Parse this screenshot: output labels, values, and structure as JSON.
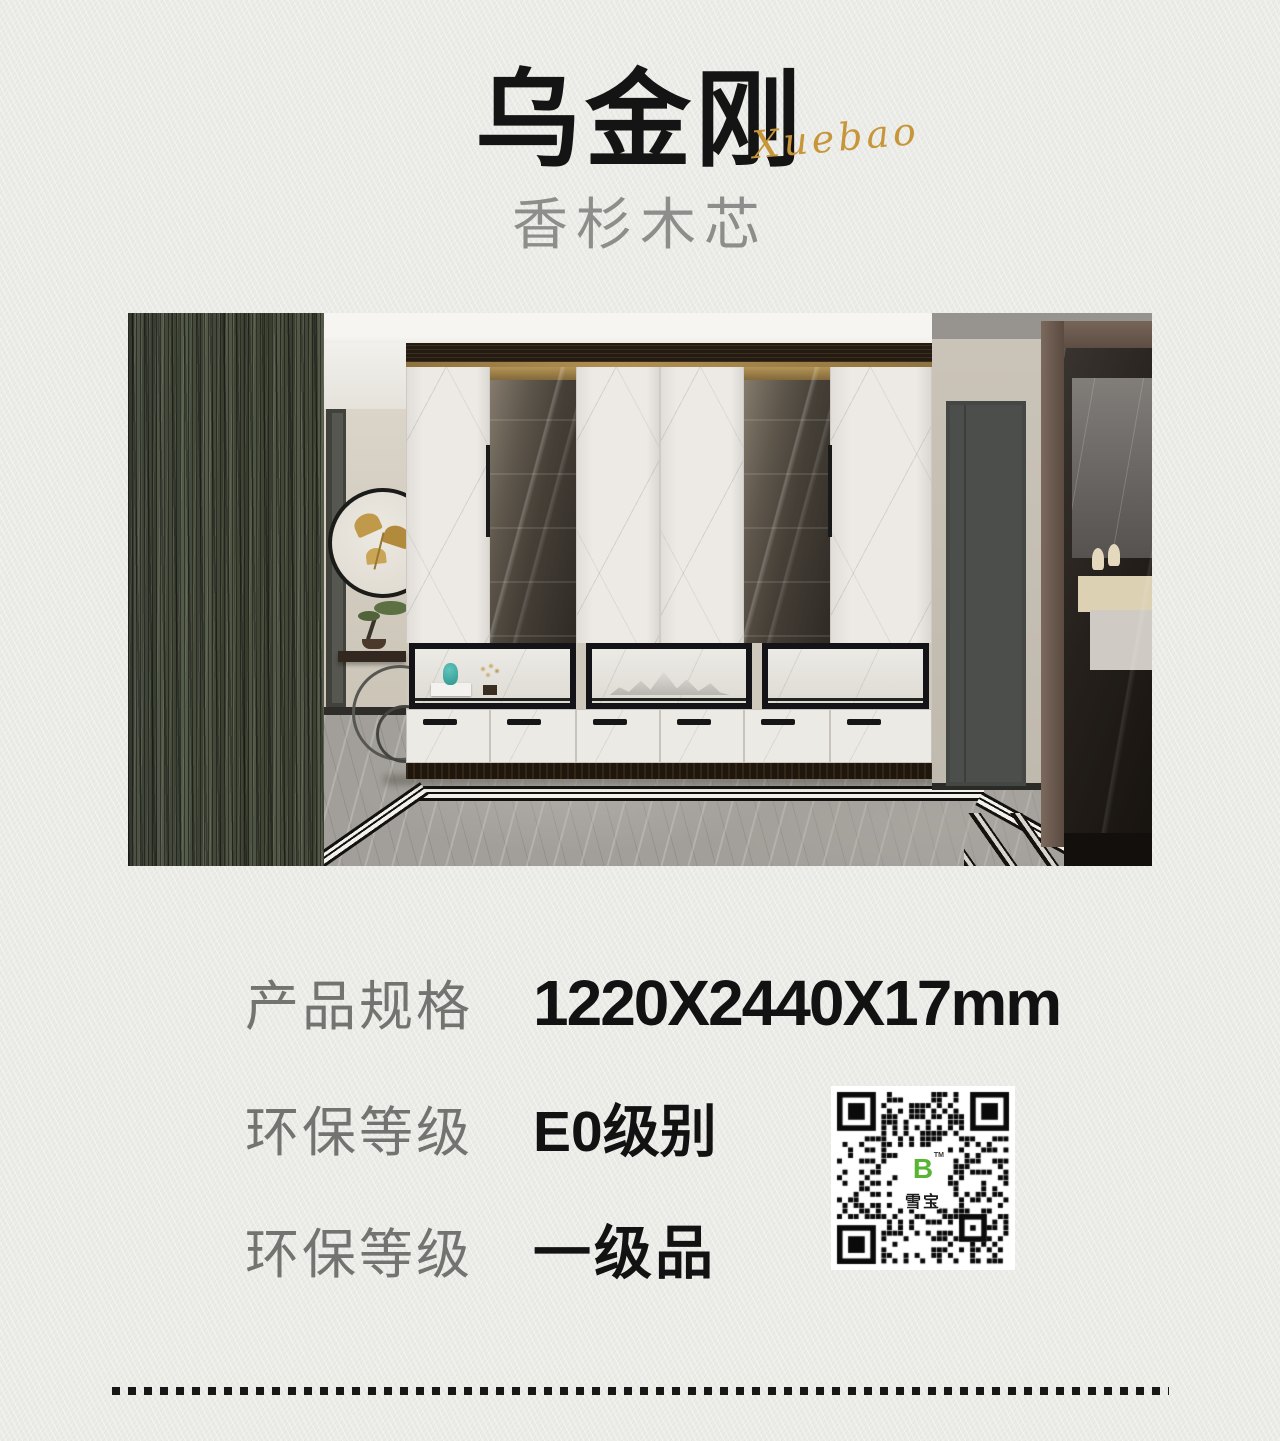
{
  "header": {
    "title": "乌金刚",
    "brand_script": "Xuebao",
    "subtitle": "香杉木芯"
  },
  "specs": [
    {
      "label": "产品规格",
      "value": "1220X2440X17mm"
    },
    {
      "label": "环保等级",
      "value": "E0级别"
    },
    {
      "label": "环保等级",
      "value": "一级品"
    }
  ],
  "qr": {
    "logo_letter": "B",
    "tm_mark": "TM",
    "center_label": "雪宝",
    "logo_color": "#58b432"
  },
  "colors": {
    "background": "#ebece8",
    "title": "#141414",
    "accent_gold": "#c8963a",
    "label_gray": "#737371",
    "value_black": "#121212",
    "wood_strip": "#4a4f3f"
  }
}
